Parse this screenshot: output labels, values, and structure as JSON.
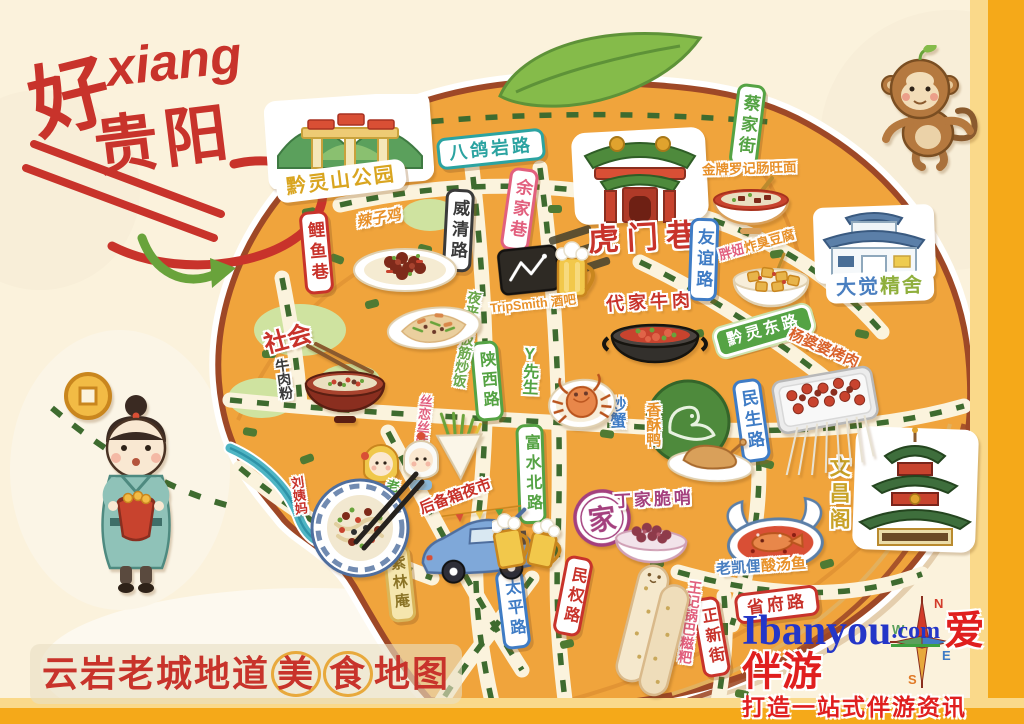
{
  "title": {
    "char1": "好",
    "pinyin": "xiang",
    "chars2": "贵阳"
  },
  "map_title": {
    "prefix": "云岩老城地道",
    "circled1": "美",
    "circled2": "食",
    "suffix": "地图"
  },
  "landmarks": {
    "qianlingshan_park": {
      "label": "黔灵山公园"
    },
    "dajue_jingshe": {
      "label1": "大觉",
      "label2": "精舍"
    },
    "wenchang_pavilion": {
      "label": "文昌阁"
    },
    "humen_alley": {
      "label": "虎门巷"
    },
    "zilinan": {
      "label": "紫林庵"
    }
  },
  "streets": {
    "bageyan_road": {
      "label": "八鸽岩路"
    },
    "yujia_alley": {
      "label": "余家巷"
    },
    "weiqing_road": {
      "label": "威清路"
    },
    "caijia_street": {
      "label": "蔡家街"
    },
    "youyi_road": {
      "label": "友谊路"
    },
    "qianling_east_road": {
      "label": "黔灵东路"
    },
    "minsheng_road": {
      "label": "民生路"
    },
    "shaanxi_road": {
      "label": "陕西路"
    },
    "fushui_north_road": {
      "label": "富水北路"
    },
    "minquan_road": {
      "label": "民权路"
    },
    "taiping_road": {
      "label": "太平路"
    },
    "zhengxin_street": {
      "label": "正新街"
    },
    "shengfu_road": {
      "label": "省府路"
    },
    "liyu_alley": {
      "label": "鲤鱼巷"
    }
  },
  "foods": {
    "laziji": {
      "label": "辣子鸡"
    },
    "shehui_beef_noodles": {
      "label1": "社会",
      "label2": "牛肉粉"
    },
    "yelaixiang": {
      "label": "夜来香板筋炒饭"
    },
    "tripsmith_bar": {
      "label": "TripSmith 酒吧"
    },
    "daijia_beef": {
      "label": "代家牛肉"
    },
    "luoji_noodles": {
      "label": "金牌罗记肠旺面"
    },
    "pangniu_tofu": {
      "label1": "胖妞",
      "label2": "炸臭豆腐"
    },
    "chaoxie": {
      "label": "炒蟹"
    },
    "xiangsu_duck": {
      "label": "香酥鸭"
    },
    "dingjia_cuishao": {
      "label": "丁家脆哨",
      "seal": "家"
    },
    "laokaili_fish": {
      "label1": "老凯俚",
      "label2": "酸汤鱼"
    },
    "wangji_ciba": {
      "label": "王记锅巴糍粑"
    },
    "yangpopo_bbq": {
      "label": "杨婆婆烤肉"
    },
    "silian_siwawa": {
      "label": "丝恋丝娃娃"
    },
    "trunk_night_market": {
      "label": "后备箱夜市"
    },
    "laosufen": {
      "label1": "刘姨妈",
      "label2": "老素粉"
    },
    "mr_y": {
      "label": "Y先生"
    }
  },
  "watermark": {
    "brand_en": "Ibanyou",
    "domain": ".com",
    "brand_cn": "爱伴游",
    "tagline": "打造一站式伴游资讯"
  },
  "compass": {
    "n": "N",
    "e": "E",
    "s": "S",
    "w": "W"
  },
  "colors": {
    "background": "#FBF2DC",
    "map_fill": "#F0A43C",
    "map_border": "#9E4827",
    "frame": "#F5A919",
    "road_dash": "#3E6B2F",
    "river": "#4FB5C4",
    "title_red": "#C8332B",
    "watermark_blue": "#2436C8",
    "watermark_red": "#E01F1F"
  }
}
